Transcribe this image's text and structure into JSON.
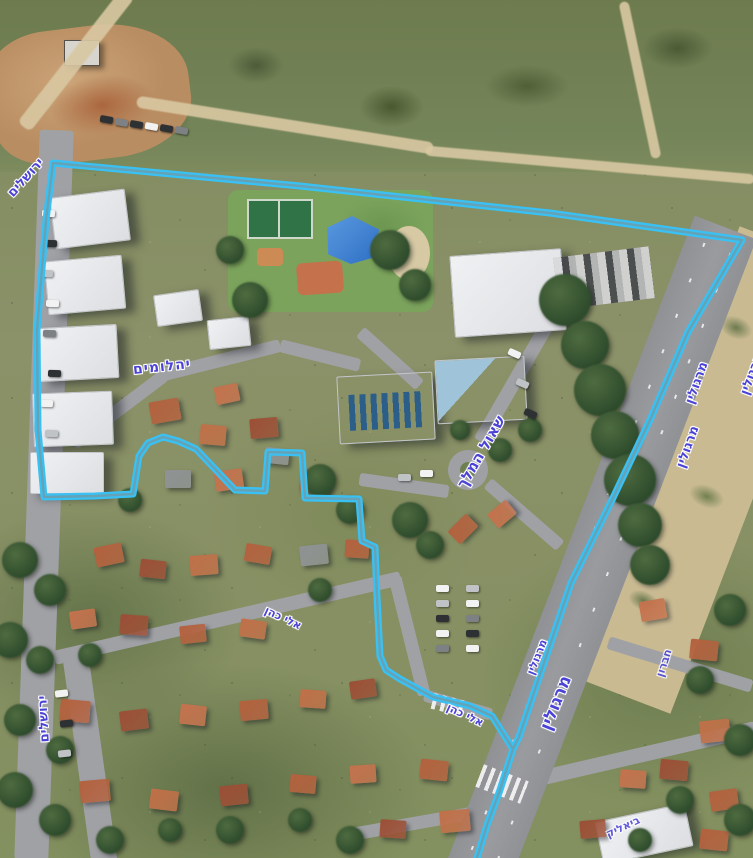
{
  "labels": {
    "yerushalayim_top": "ירושלים",
    "yahalomim": "יהלומים",
    "shaul_hamelech": "שאול המלך",
    "margolin": [
      "מרגולין",
      "מרגולין",
      "מרגולין",
      "מרגולין",
      "מרגולין"
    ],
    "eli_cohen": [
      "אלי כהן",
      "אלי כהן"
    ],
    "yerushalayim_left": "ירושלים",
    "hevron": "חברון",
    "bialik": "ביאליק"
  },
  "overlay": {
    "boundary_color": "#3ac1f3",
    "label_color": "#4b43d6"
  }
}
